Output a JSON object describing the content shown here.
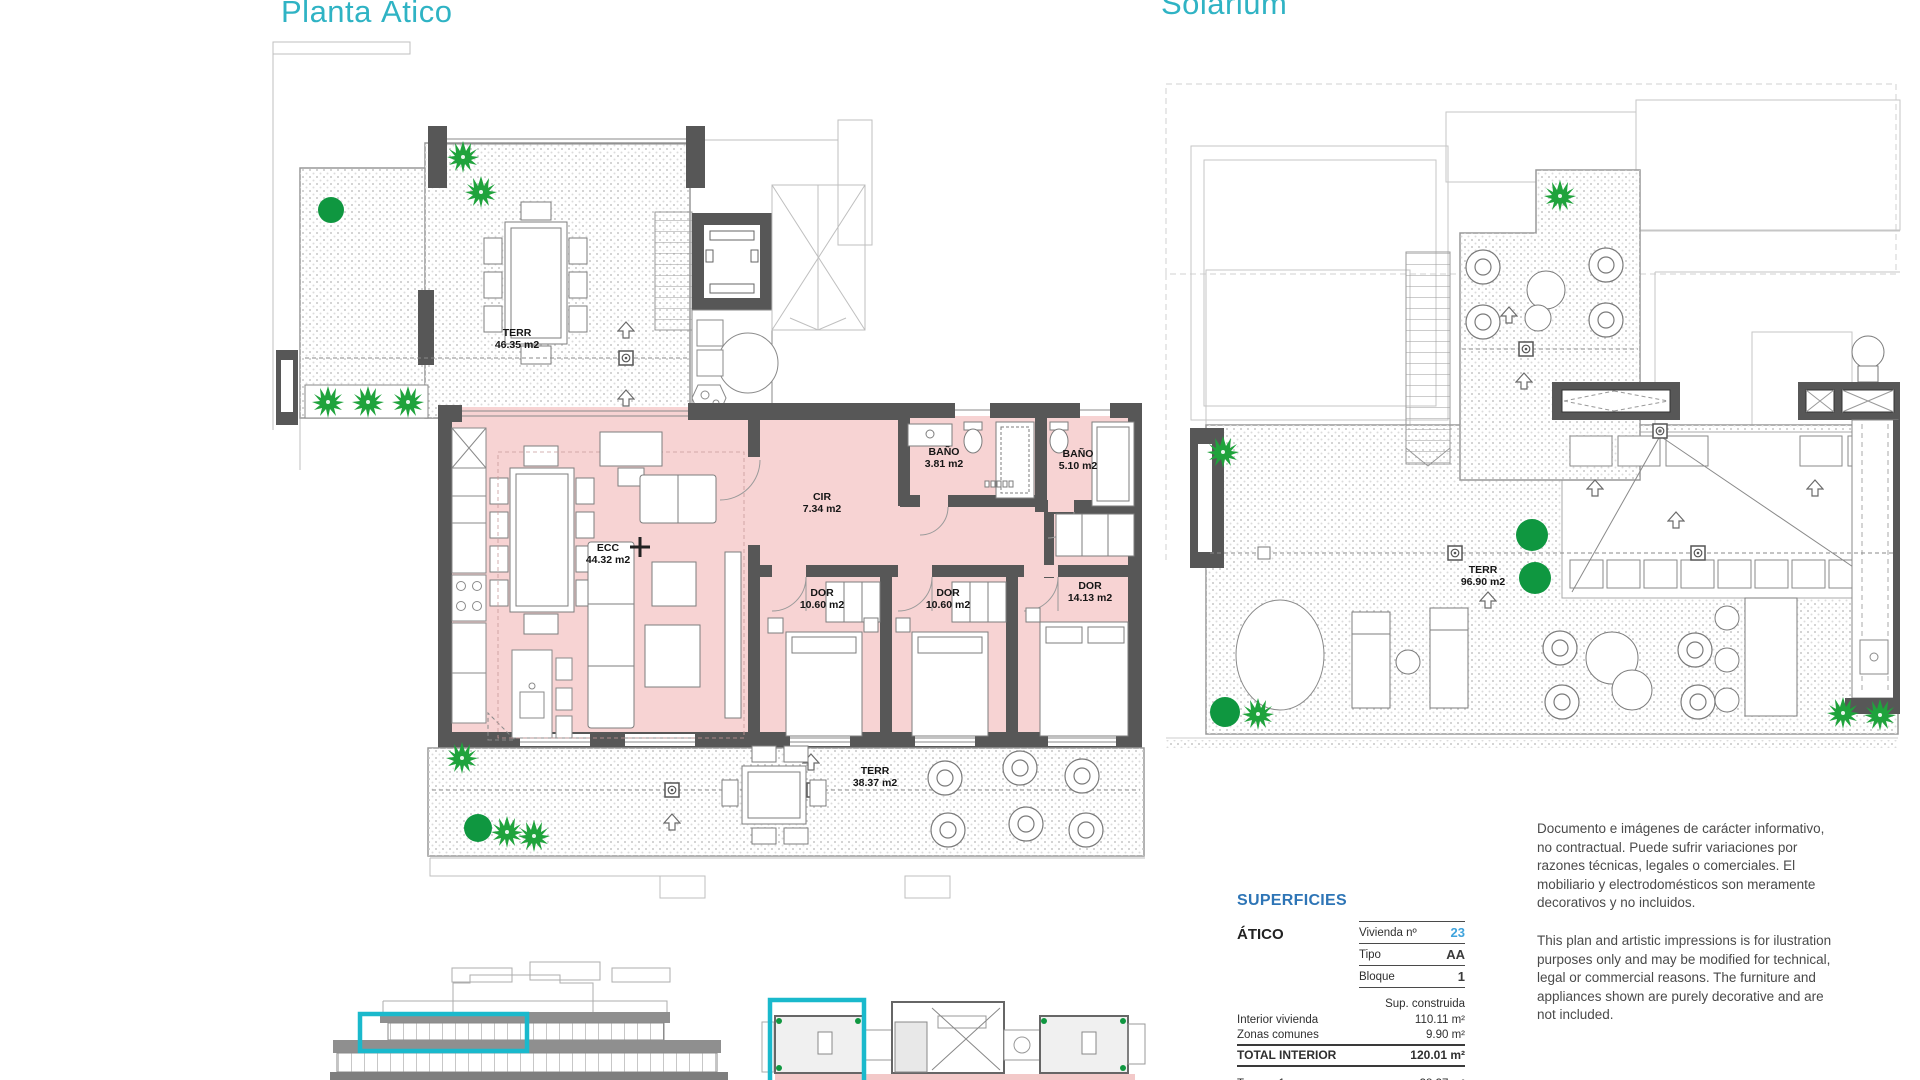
{
  "titles": {
    "left": "Planta Ático",
    "right": "Solarium"
  },
  "plan_atico": {
    "rooms": [
      {
        "id": "terraza-superior",
        "name": "TERR",
        "area": "46.35 m2"
      },
      {
        "id": "estar-comedor-cocina",
        "name": "ECC",
        "area": "44.32 m2"
      },
      {
        "id": "circulacion",
        "name": "CIR",
        "area": "7.34 m2"
      },
      {
        "id": "bano-1",
        "name": "BAÑO",
        "area": "3.81 m2"
      },
      {
        "id": "bano-2",
        "name": "BAÑO",
        "area": "5.10 m2"
      },
      {
        "id": "dormitorio-1",
        "name": "DOR",
        "area": "10.60 m2"
      },
      {
        "id": "dormitorio-2",
        "name": "DOR",
        "area": "10.60 m2"
      },
      {
        "id": "dormitorio-3",
        "name": "DOR",
        "area": "14.13 m2"
      },
      {
        "id": "terraza-inferior",
        "name": "TERR",
        "area": "38.37 m2"
      }
    ]
  },
  "plan_solarium": {
    "rooms": [
      {
        "id": "terraza-solarium",
        "name": "TERR",
        "area": "96.90 m2"
      }
    ]
  },
  "superficies": {
    "title": "SUPERFICIES",
    "section": "ÁTICO",
    "unit_rows": [
      {
        "label": "Vivienda nº",
        "value": "23"
      },
      {
        "label": "Tipo",
        "value": "AA"
      },
      {
        "label": "Bloque",
        "value": "1"
      }
    ],
    "sup_header": "Sup. construida",
    "area_rows": [
      {
        "label": "Interior vivienda",
        "value": "110.11 m²"
      },
      {
        "label": "Zonas comunes",
        "value": "9.90 m²"
      }
    ],
    "total_row": {
      "label": "TOTAL INTERIOR",
      "value": "120.01 m²"
    },
    "terraza_row": {
      "label": "Terraza 1",
      "value": "38.37 m²"
    }
  },
  "disclaimer": {
    "es": "Documento e imágenes de carácter informativo, no contractual. Puede sufrir variaciones por razones técnicas, legales o comerciales. El mobiliario y electrodomésticos son meramente decorativos y no incluidos.",
    "en": "This plan and artistic impressions is for ilustration purposes only and may be modified for technical, legal or commercial reasons. The furniture and appliances shown are purely decorative and are not included."
  },
  "colors": {
    "title_teal": "#2fb3c4",
    "highlight_teal": "#1ab9cc",
    "table_blue": "#2e75b6",
    "value_blue": "#3fa3dc",
    "room_pink": "#f7d3d3",
    "wall_gray": "#575757",
    "plant_green": "#1fa33c",
    "plant_dark_green": "#0f9740"
  }
}
